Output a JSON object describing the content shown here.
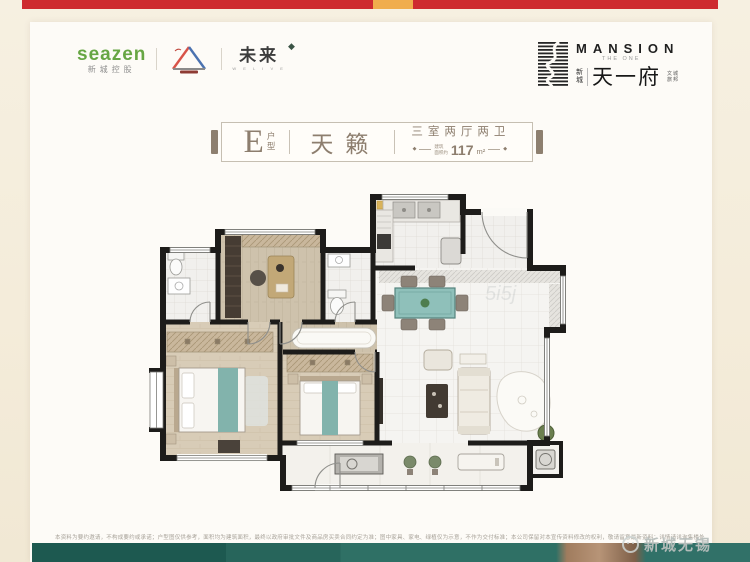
{
  "header": {
    "seazen_brand": "seazen",
    "seazen_sub": "新城控股",
    "future_label": "未来",
    "future_diamond": "◆",
    "future_tagline": "W E  L I V E",
    "mansion_title": "MANSION",
    "mansion_subtitle": "THE ONE",
    "mansion_cn_prefix_1": "新",
    "mansion_cn_prefix_2": "城",
    "mansion_cn_name": "天一府",
    "mansion_cn_side_1a": "文",
    "mansion_cn_side_1b": "旅",
    "mansion_cn_side_2a": "城",
    "mansion_cn_side_2b": "邦"
  },
  "title_block": {
    "type_letter": "E",
    "type_suffix_1": "户",
    "type_suffix_2": "型",
    "name": "天籁",
    "spec": "三室两厅两卫",
    "diamond": "◆",
    "area_label_1": "建筑",
    "area_label_2": "面积约",
    "area_value": "117",
    "area_unit": "m²"
  },
  "floorplan": {
    "watermark": "5i5j"
  },
  "footer": {
    "disclaimer": "本资料为要约邀请，不构成要约或承诺；户型图仅供参考，面积均为建筑面积，最终以政府审批文件及商品房买卖合同约定为准；图中家具、家电、绿植仅为示意，不作为交付标准；本公司保留对本宣传资料修改的权利，敬请留意最新资料；详情请详询售楼处；本户型建筑面积约117㎡，三室两厅两卫；部分内容来源于网络，如有侵权请联系删除。",
    "watermark": "新城无锡"
  },
  "colors": {
    "topbar_red": "#ce2b30",
    "topbar_orange": "#f0ad4d",
    "seazen_green": "#67a644",
    "title_brown": "#8d7e6e",
    "teal_accent": "#82b3ac",
    "footer_teal": "#2f7065",
    "footer_tan": "#b79477"
  }
}
